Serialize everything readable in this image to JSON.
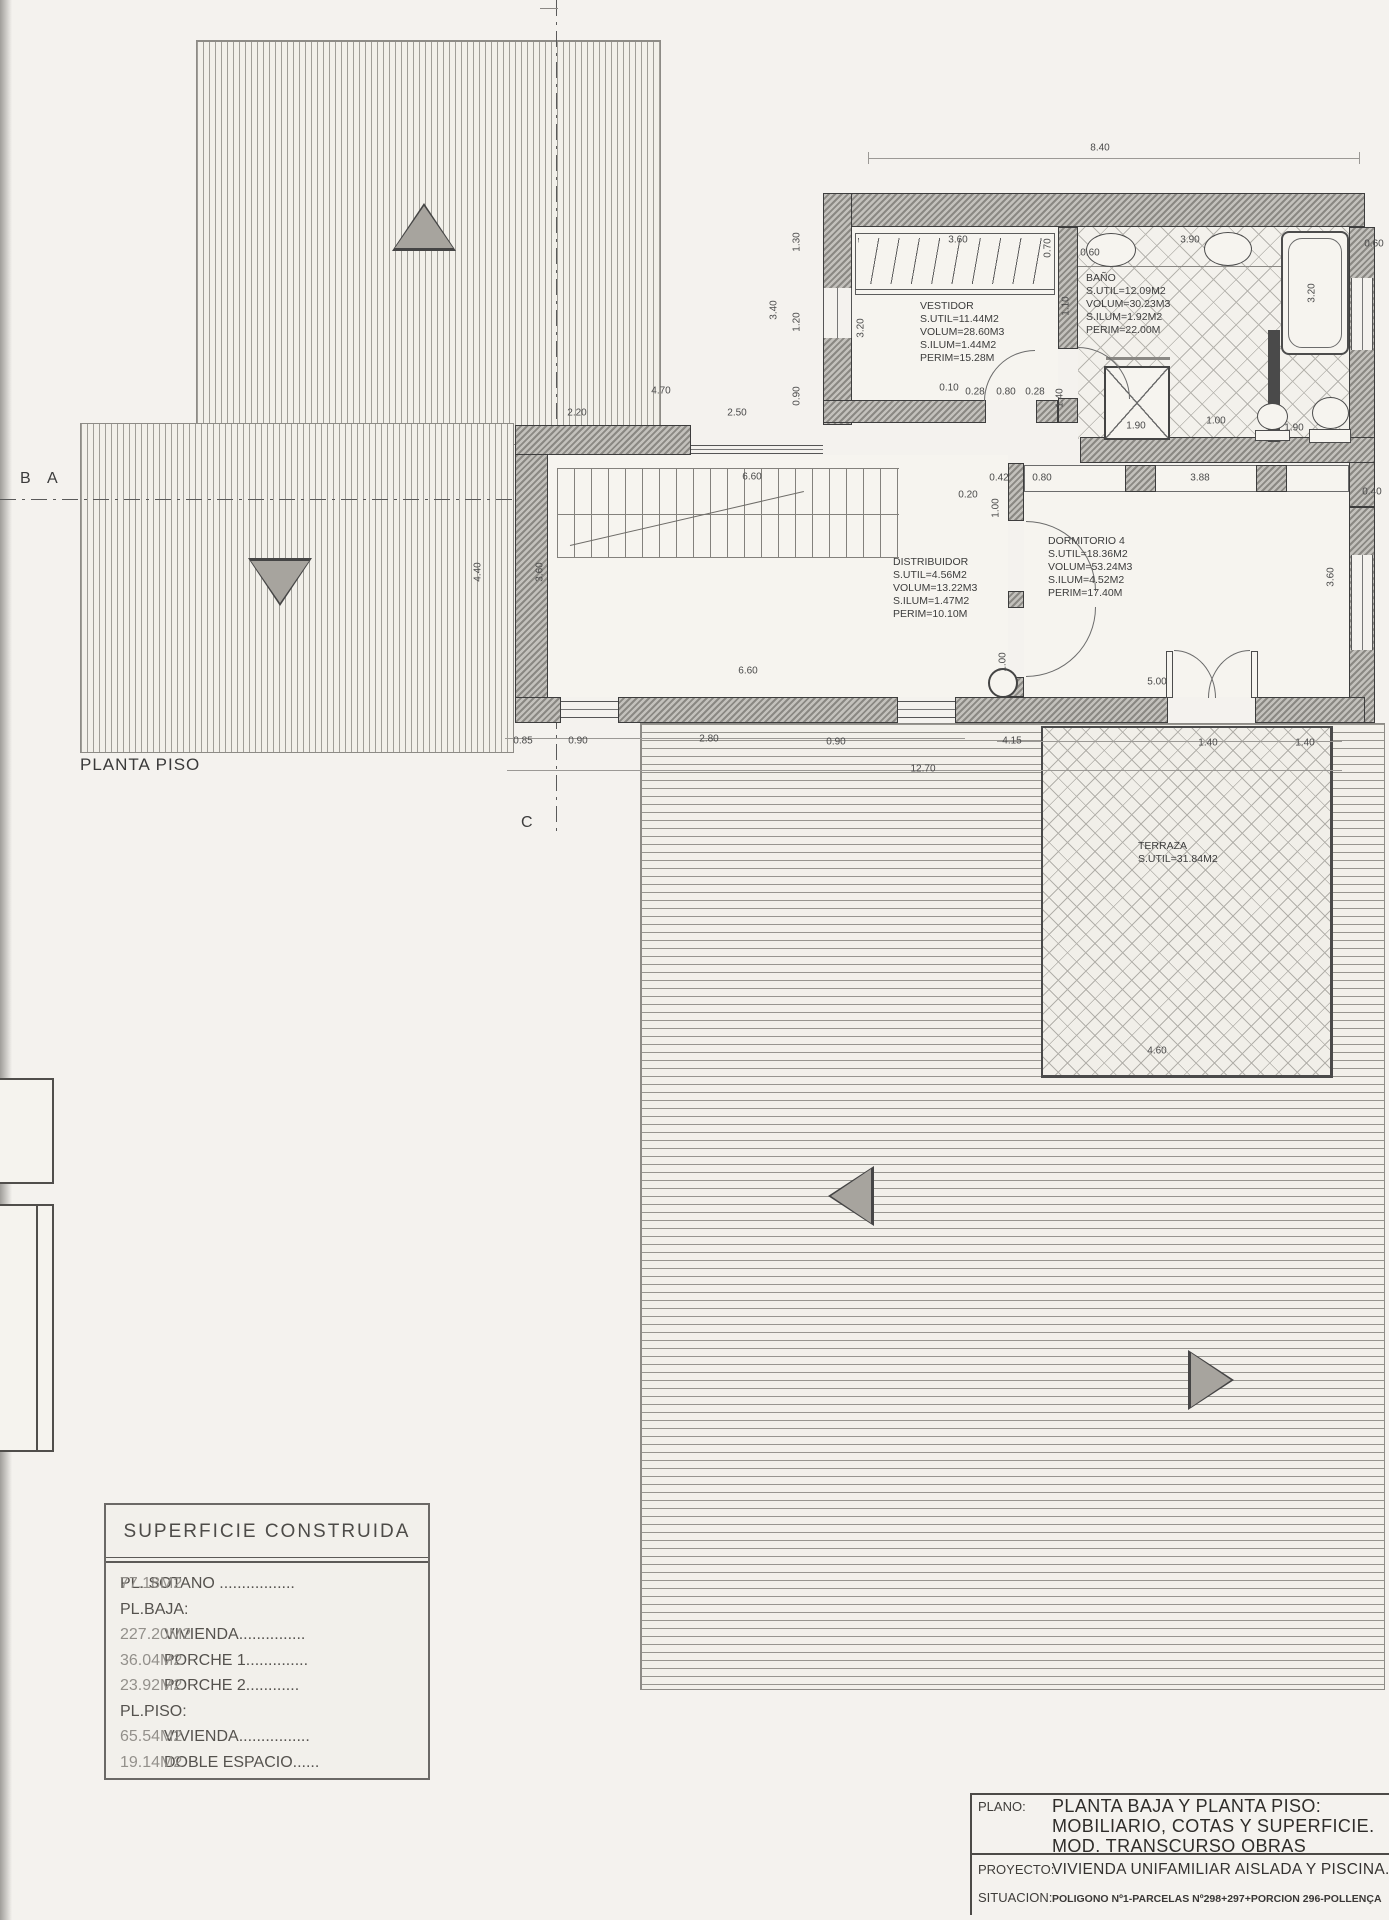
{
  "colors": {
    "paper": "#f4f2ee",
    "ink": "#3b3b3b",
    "wall_hatch": "#8a8883",
    "pattern_grey": "#b2b0aa"
  },
  "labels": {
    "floor": "PLANTA PISO",
    "marker_b": "B",
    "marker_a": "A",
    "marker_c": "C"
  },
  "rooms": [
    {
      "name": "VESTIDOR",
      "lines": [
        "S.UTIL=11.44M2",
        "VOLUM=28.60M3",
        "S.ILUM=1.44M2",
        "PERIM=15.28M"
      ]
    },
    {
      "name": "BAÑO",
      "lines": [
        "S.UTIL=12.09M2",
        "VOLUM=30.23M3",
        "S.ILUM=1.92M2",
        "PERIM=22.00M"
      ]
    },
    {
      "name": "DISTRIBUIDOR",
      "lines": [
        "S.UTIL=4.56M2",
        "VOLUM=13.22M3",
        "S.ILUM=1.47M2",
        "PERIM=10.10M"
      ]
    },
    {
      "name": "DORMITORIO 4",
      "lines": [
        "S.UTIL=18.36M2",
        "VOLUM=53.24M3",
        "S.ILUM=4.52M2",
        "PERIM=17.40M"
      ]
    },
    {
      "name": "TERRAZA",
      "lines": [
        "S.UTIL=31.84M2"
      ]
    }
  ],
  "dimensions": [
    {
      "t": "8.40",
      "x": 1100,
      "y": 148
    },
    {
      "t": "1.30",
      "x": 797,
      "y": 242,
      "r": 1
    },
    {
      "t": "3.40",
      "x": 774,
      "y": 310,
      "r": 1
    },
    {
      "t": "1.20",
      "x": 797,
      "y": 322,
      "r": 1
    },
    {
      "t": "3.20",
      "x": 861,
      "y": 328,
      "r": 1
    },
    {
      "t": "0.90",
      "x": 797,
      "y": 396,
      "r": 1
    },
    {
      "t": "3.60",
      "x": 958,
      "y": 240
    },
    {
      "t": "0.70",
      "x": 1048,
      "y": 248,
      "r": 1
    },
    {
      "t": "0.60",
      "x": 1090,
      "y": 253
    },
    {
      "t": "3.90",
      "x": 1190,
      "y": 240
    },
    {
      "t": "0.60",
      "x": 1374,
      "y": 244
    },
    {
      "t": "1.10",
      "x": 1066,
      "y": 306,
      "r": 1
    },
    {
      "t": "3.20",
      "x": 1312,
      "y": 293,
      "r": 1
    },
    {
      "t": "0.10",
      "x": 949,
      "y": 388
    },
    {
      "t": "0.28",
      "x": 975,
      "y": 392
    },
    {
      "t": "0.80",
      "x": 1006,
      "y": 392
    },
    {
      "t": "0.28",
      "x": 1035,
      "y": 392
    },
    {
      "t": "1.40",
      "x": 1060,
      "y": 398,
      "r": 1
    },
    {
      "t": "2.20",
      "x": 577,
      "y": 413
    },
    {
      "t": "4.70",
      "x": 661,
      "y": 391
    },
    {
      "t": "2.50",
      "x": 737,
      "y": 413
    },
    {
      "t": "6.60",
      "x": 752,
      "y": 477
    },
    {
      "t": "0.20",
      "x": 968,
      "y": 495
    },
    {
      "t": "0.42",
      "x": 999,
      "y": 478
    },
    {
      "t": "0.80",
      "x": 1042,
      "y": 478
    },
    {
      "t": "3.88",
      "x": 1200,
      "y": 478
    },
    {
      "t": "0.40",
      "x": 1372,
      "y": 492
    },
    {
      "t": "1.00",
      "x": 996,
      "y": 508,
      "r": 1
    },
    {
      "t": "4.40",
      "x": 478,
      "y": 572,
      "r": 1
    },
    {
      "t": "3.60",
      "x": 540,
      "y": 572,
      "r": 1
    },
    {
      "t": "3.60",
      "x": 1331,
      "y": 577,
      "r": 1
    },
    {
      "t": "6.60",
      "x": 748,
      "y": 671
    },
    {
      "t": "1.00",
      "x": 1003,
      "y": 662,
      "r": 1
    },
    {
      "t": "5.00",
      "x": 1157,
      "y": 682
    },
    {
      "t": "1.90",
      "x": 1136,
      "y": 426
    },
    {
      "t": "1.00",
      "x": 1216,
      "y": 421
    },
    {
      "t": "1.90",
      "x": 1294,
      "y": 428
    },
    {
      "t": "0.85",
      "x": 523,
      "y": 741
    },
    {
      "t": "0.90",
      "x": 578,
      "y": 741
    },
    {
      "t": "2.80",
      "x": 709,
      "y": 739
    },
    {
      "t": "0.90",
      "x": 836,
      "y": 742
    },
    {
      "t": "4.15",
      "x": 1012,
      "y": 741
    },
    {
      "t": "1.40",
      "x": 1208,
      "y": 743
    },
    {
      "t": "1.40",
      "x": 1305,
      "y": 743
    },
    {
      "t": "12.70",
      "x": 923,
      "y": 769
    },
    {
      "t": "4.60",
      "x": 1157,
      "y": 1051
    }
  ],
  "area_table": {
    "title": "SUPERFICIE CONSTRUIDA",
    "rows": [
      {
        "label": "PL. SOTANO .................",
        "value": "77.18M2",
        "indent": 0
      },
      {
        "label": "PL.BAJA:",
        "value": "",
        "indent": 0
      },
      {
        "label": "VIVIENDA...............",
        "value": "227.20M2",
        "indent": 1
      },
      {
        "label": "PORCHE 1..............",
        "value": "36.04M2",
        "indent": 1
      },
      {
        "label": "PORCHE 2............",
        "value": "23.92M2",
        "indent": 1
      },
      {
        "label": "PL.PISO:",
        "value": "",
        "indent": 0
      },
      {
        "label": "VIVIENDA................",
        "value": "65.54M2",
        "indent": 1
      },
      {
        "label": "DOBLE ESPACIO......",
        "value": "19.14M2",
        "indent": 1
      }
    ]
  },
  "title_block": {
    "plano_label": "PLANO:",
    "plano_line1": "PLANTA BAJA Y PLANTA PISO:",
    "plano_line2": "MOBILIARIO, COTAS Y SUPERFICIE.",
    "plano_line3": "MOD. TRANSCURSO OBRAS",
    "proyecto_label": "PROYECTO:",
    "proyecto_value": "VIVIENDA UNIFAMILIAR AISLADA Y PISCINA.",
    "situacion_label": "SITUACION:",
    "situacion_value": "POLIGONO Nº1-PARCELAS Nº298+297+PORCION 296-POLLENÇA"
  }
}
